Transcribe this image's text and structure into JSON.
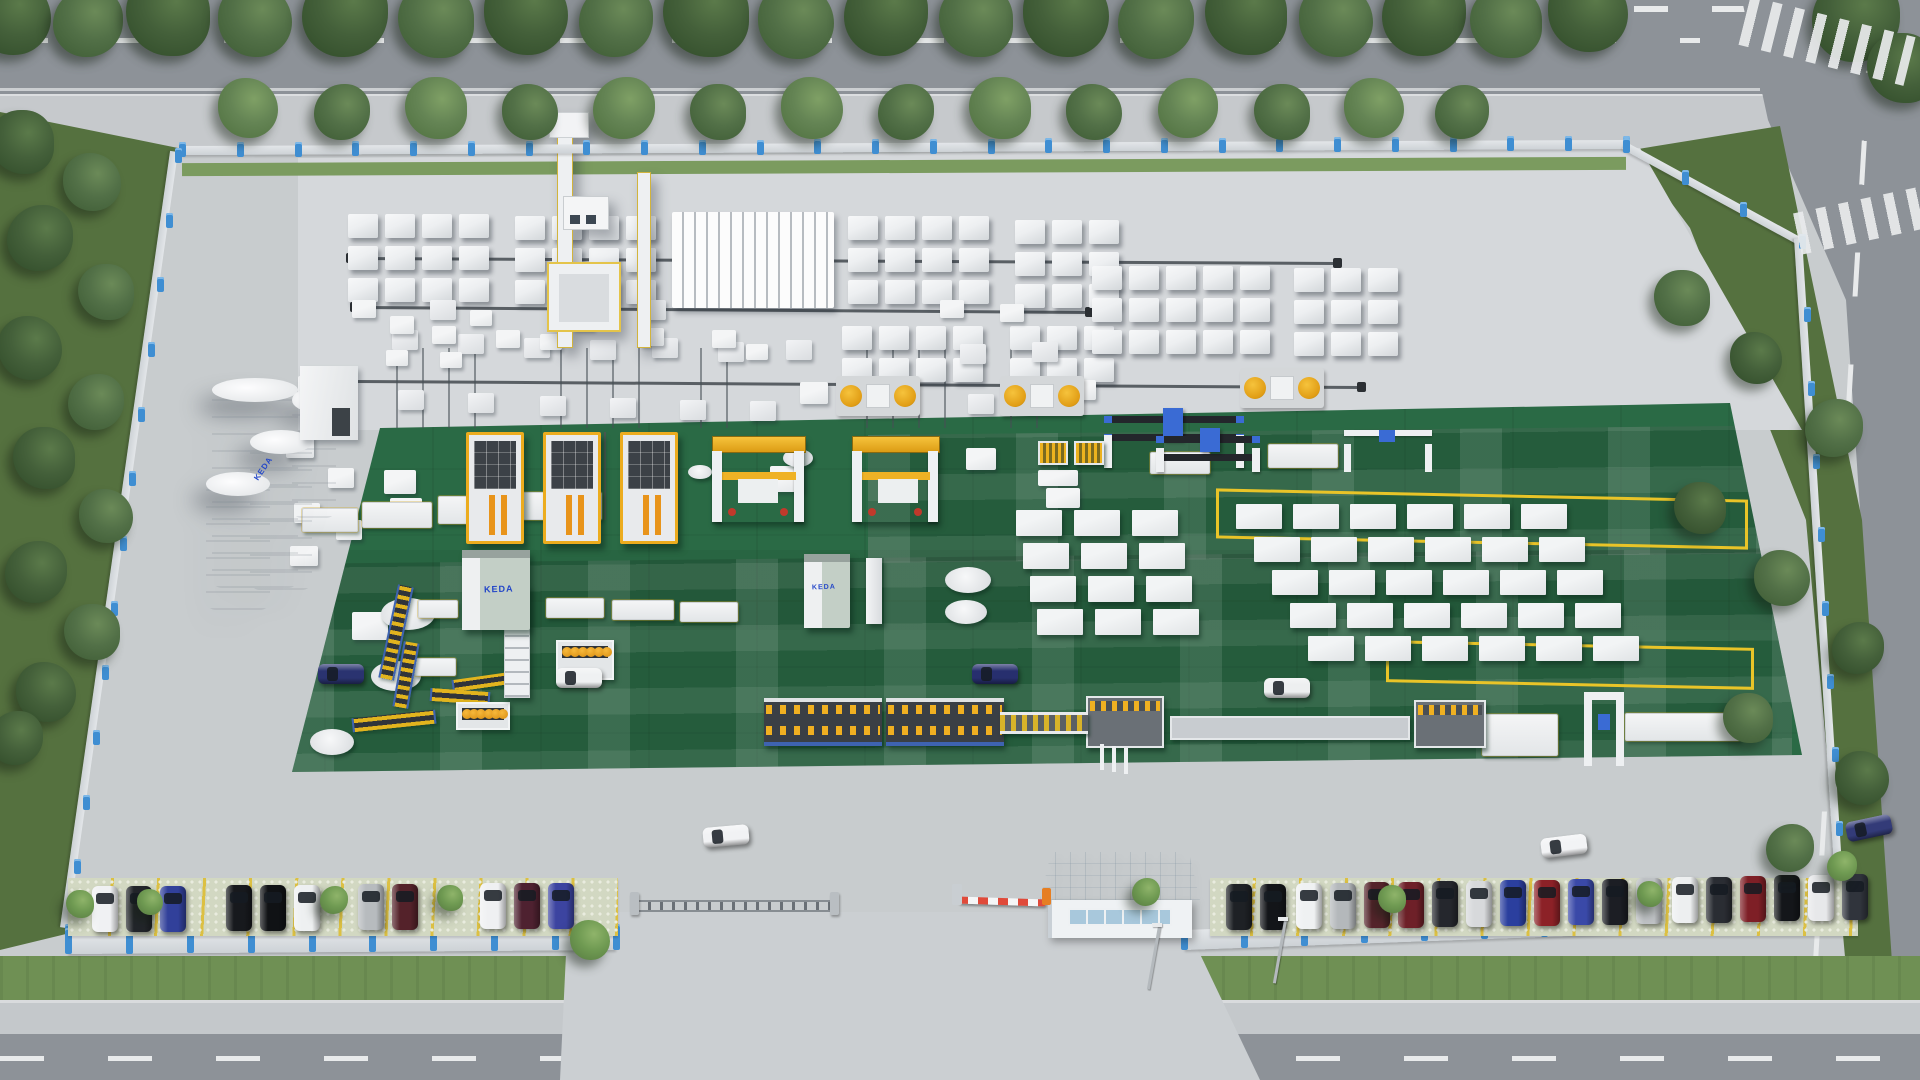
{
  "logo": {
    "text": "KEDA",
    "color": "#2447c8"
  },
  "palette": {
    "asphalt": "#8d9298",
    "sidewalk": "#c6c9cc",
    "apron": "#c8ccce",
    "apron_inner": "#d5d8db",
    "green_floor": "#2a6a45",
    "grass": "#6f9054",
    "grass_dark": "#55713f",
    "tree_dark": "#3f5c35",
    "tree_mid": "#587747",
    "tree_light": "#79965b",
    "bush": "#7da35c",
    "fence_wall": "#dadee1",
    "fence_post": "#3f8ed2",
    "block_white": "#eef0f2",
    "machine_yellow": "#f2b02a",
    "gantry_blue": "#3a6bd4",
    "keda_blue": "#2447c8",
    "silo_white": "#f3f4f5",
    "roof_blue": "#dfe7ed",
    "marking_yellow": "#e9c428",
    "parking_line": "#dcc043",
    "barrier_red": "#e04a3a",
    "road_line": "#e8eaeb",
    "rail": "#595f64"
  },
  "scene": {
    "trees": [
      [
        12,
        16,
        78,
        0
      ],
      [
        88,
        22,
        70,
        1
      ],
      [
        168,
        14,
        84,
        0
      ],
      [
        255,
        20,
        74,
        1
      ],
      [
        345,
        14,
        86,
        0
      ],
      [
        436,
        20,
        76,
        1
      ],
      [
        526,
        13,
        84,
        0
      ],
      [
        616,
        20,
        74,
        1
      ],
      [
        706,
        14,
        86,
        0
      ],
      [
        796,
        21,
        76,
        1
      ],
      [
        886,
        14,
        84,
        0
      ],
      [
        976,
        20,
        74,
        1
      ],
      [
        1066,
        14,
        86,
        0
      ],
      [
        1156,
        21,
        76,
        1
      ],
      [
        1246,
        14,
        82,
        0
      ],
      [
        1336,
        20,
        74,
        1
      ],
      [
        1424,
        14,
        84,
        0
      ],
      [
        1506,
        22,
        72,
        1
      ],
      [
        1588,
        12,
        80,
        0
      ],
      [
        1856,
        18,
        88,
        0
      ],
      [
        1902,
        68,
        70,
        0
      ],
      [
        248,
        108,
        60,
        2
      ],
      [
        342,
        112,
        56,
        1
      ],
      [
        436,
        108,
        62,
        2
      ],
      [
        530,
        112,
        56,
        1
      ],
      [
        624,
        108,
        62,
        2
      ],
      [
        718,
        112,
        56,
        1
      ],
      [
        812,
        108,
        62,
        2
      ],
      [
        906,
        112,
        56,
        1
      ],
      [
        1000,
        108,
        62,
        2
      ],
      [
        1094,
        112,
        56,
        1
      ],
      [
        1188,
        108,
        60,
        2
      ],
      [
        1282,
        112,
        56,
        1
      ],
      [
        1374,
        108,
        60,
        2
      ],
      [
        1462,
        112,
        54,
        1
      ],
      [
        22,
        142,
        64,
        0
      ],
      [
        92,
        182,
        58,
        1
      ],
      [
        40,
        238,
        66,
        0
      ],
      [
        106,
        292,
        56,
        1
      ],
      [
        30,
        348,
        64,
        0
      ],
      [
        96,
        402,
        56,
        1
      ],
      [
        44,
        458,
        62,
        0
      ],
      [
        106,
        516,
        54,
        1
      ],
      [
        36,
        572,
        62,
        0
      ],
      [
        92,
        632,
        56,
        1
      ],
      [
        46,
        692,
        60,
        0
      ],
      [
        16,
        738,
        54,
        0
      ],
      [
        1682,
        298,
        56,
        1
      ],
      [
        1756,
        358,
        52,
        0
      ],
      [
        1834,
        428,
        58,
        1
      ],
      [
        1700,
        508,
        52,
        0
      ],
      [
        1782,
        578,
        56,
        1
      ],
      [
        1858,
        648,
        52,
        0
      ],
      [
        1748,
        718,
        50,
        1
      ],
      [
        1862,
        778,
        54,
        0
      ],
      [
        1790,
        848,
        48,
        1
      ],
      [
        80,
        904,
        28,
        3
      ],
      [
        150,
        902,
        26,
        3
      ],
      [
        334,
        900,
        28,
        3
      ],
      [
        450,
        898,
        26,
        3
      ],
      [
        590,
        940,
        40,
        3
      ],
      [
        1146,
        892,
        28,
        3
      ],
      [
        1392,
        899,
        28,
        3
      ],
      [
        1650,
        894,
        26,
        3
      ],
      [
        1842,
        866,
        30,
        3
      ]
    ],
    "fence": [
      [
        182,
        146,
        1626,
        140,
        9,
        26
      ],
      [
        178,
        152,
        68,
        928,
        8,
        13
      ],
      [
        1626,
        142,
        1802,
        238,
        8,
        4
      ],
      [
        1802,
        238,
        1844,
        898,
        8,
        10
      ],
      [
        68,
        934,
        616,
        930,
        20,
        10
      ],
      [
        1184,
        930,
        1844,
        906,
        20,
        12
      ]
    ],
    "runways": [
      [
        352,
        257,
        1336,
        262
      ],
      [
        356,
        306,
        1088,
        311
      ],
      [
        352,
        380,
        1360,
        386
      ]
    ],
    "vrails": {
      "y": 348,
      "h": 80,
      "xs": [
        396,
        422,
        448,
        474,
        560,
        586,
        612,
        638,
        700,
        726,
        866,
        892,
        918,
        944,
        1010,
        1036
      ]
    },
    "grails": {
      "y": 432,
      "h": 88,
      "xs": [
        520,
        548,
        576,
        604,
        632,
        660
      ]
    },
    "block_clusters": [
      [
        348,
        214,
        4,
        3
      ],
      [
        515,
        216,
        4,
        3
      ],
      [
        848,
        216,
        4,
        3
      ],
      [
        842,
        326,
        4,
        2
      ],
      [
        1015,
        220,
        3,
        3
      ],
      [
        1010,
        326,
        3,
        2
      ],
      [
        1092,
        266,
        5,
        3
      ],
      [
        1294,
        268,
        3,
        3
      ]
    ],
    "block_train": [
      672,
      212,
      162,
      96
    ],
    "small_stacks": [
      [
        392,
        330
      ],
      [
        458,
        334
      ],
      [
        524,
        338
      ],
      [
        590,
        340
      ],
      [
        652,
        338
      ],
      [
        718,
        342
      ],
      [
        786,
        340
      ],
      [
        960,
        344
      ],
      [
        1032,
        342
      ],
      [
        398,
        390
      ],
      [
        468,
        393
      ],
      [
        540,
        396
      ],
      [
        610,
        398
      ],
      [
        680,
        400
      ],
      [
        750,
        401
      ],
      [
        968,
        394
      ],
      [
        1040,
        390
      ],
      [
        430,
        300
      ],
      [
        640,
        300
      ]
    ],
    "white_boxes": [
      [
        298,
        376,
        26,
        20
      ],
      [
        310,
        404,
        26,
        20
      ],
      [
        286,
        436,
        28,
        22
      ],
      [
        328,
        468,
        26,
        20
      ],
      [
        294,
        503,
        26,
        20
      ],
      [
        336,
        520,
        26,
        20
      ],
      [
        290,
        546,
        28,
        20
      ],
      [
        384,
        470,
        32,
        24
      ],
      [
        390,
        498,
        32,
        24
      ],
      [
        352,
        300,
        24,
        18
      ],
      [
        390,
        316,
        24,
        18
      ],
      [
        432,
        326,
        24,
        18
      ],
      [
        386,
        350,
        22,
        16
      ],
      [
        440,
        352,
        22,
        16
      ],
      [
        470,
        310,
        22,
        16
      ],
      [
        496,
        330,
        24,
        18
      ],
      [
        540,
        334,
        22,
        16
      ],
      [
        572,
        314,
        22,
        16
      ],
      [
        640,
        328,
        24,
        18
      ],
      [
        712,
        330,
        24,
        18
      ],
      [
        746,
        344,
        22,
        16
      ],
      [
        770,
        466,
        34,
        26
      ],
      [
        352,
        612,
        36,
        28
      ],
      [
        940,
        300,
        24,
        18
      ],
      [
        1000,
        304,
        24,
        18
      ],
      [
        800,
        382,
        28,
        22
      ],
      [
        1070,
        380,
        26,
        20
      ],
      [
        966,
        448,
        30,
        22
      ],
      [
        1038,
        470,
        40,
        16
      ],
      [
        1046,
        488,
        34,
        20
      ]
    ],
    "crate_grids": [
      {
        "x": 1016,
        "y": 510,
        "cols": 3,
        "rows": 4,
        "cw": 46,
        "ch": 26,
        "gx": 12,
        "gy": 7,
        "shift": 7
      },
      {
        "x": 1236,
        "y": 504,
        "cols": 6,
        "rows": 5,
        "cw": 46,
        "ch": 25,
        "gx": 11,
        "gy": 8,
        "shift": 18
      }
    ],
    "turntables": [
      [
        408,
        614,
        27,
        16
      ],
      [
        396,
        676,
        25,
        15
      ],
      [
        332,
        742,
        22,
        13
      ],
      [
        798,
        458,
        15,
        9
      ],
      [
        968,
        580,
        23,
        13
      ],
      [
        966,
        612,
        21,
        12
      ],
      [
        700,
        472,
        12,
        7
      ]
    ],
    "conveyor_tables": [
      [
        302,
        508,
        56,
        24
      ],
      [
        362,
        502,
        70,
        26
      ],
      [
        438,
        496,
        74,
        28
      ],
      [
        516,
        492,
        86,
        28
      ],
      [
        546,
        598,
        58,
        20
      ],
      [
        612,
        600,
        62,
        20
      ],
      [
        680,
        602,
        58,
        20
      ],
      [
        418,
        600,
        40,
        18
      ],
      [
        414,
        658,
        42,
        18
      ],
      [
        1150,
        452,
        60,
        22
      ],
      [
        1268,
        444,
        70,
        24
      ],
      [
        1482,
        714,
        76,
        42
      ],
      [
        1625,
        713,
        115,
        28
      ]
    ],
    "slat_conveyors": [
      [
        388,
        585,
        16,
        95,
        12
      ],
      [
        398,
        642,
        16,
        66,
        10
      ],
      [
        352,
        714,
        84,
        14,
        -6
      ],
      [
        452,
        676,
        60,
        12,
        -8
      ],
      [
        430,
        690,
        60,
        13,
        4
      ]
    ],
    "yellow_markings": [
      [
        1216,
        494,
        532,
        50
      ],
      [
        1386,
        644,
        368,
        42
      ]
    ],
    "shadow_bands": [
      [
        868,
        430,
        950,
        128
      ],
      [
        292,
        556,
        1500,
        216
      ]
    ],
    "machines": [
      {
        "k": "casting",
        "x": 466,
        "y": 432
      },
      {
        "k": "casting",
        "x": 543,
        "y": 432
      },
      {
        "k": "casting",
        "x": 620,
        "y": 432
      },
      {
        "k": "tilt",
        "x": 712,
        "y": 436,
        "w": 92,
        "h": 86
      },
      {
        "k": "tilt",
        "x": 852,
        "y": 436,
        "w": 86,
        "h": 86
      },
      {
        "k": "rotary",
        "x": 836,
        "y": 376
      },
      {
        "k": "rotary",
        "x": 1000,
        "y": 376
      },
      {
        "k": "rotary",
        "x": 1240,
        "y": 368
      },
      {
        "k": "bluegantry",
        "x": 1104,
        "y": 408,
        "w": 140,
        "h": 60
      },
      {
        "k": "bluegantry",
        "x": 1156,
        "y": 428,
        "w": 104,
        "h": 44
      },
      {
        "k": "whitegantry",
        "x": 1344,
        "y": 426,
        "w": 88,
        "h": 46
      },
      {
        "k": "rack",
        "x": 1038,
        "y": 441
      },
      {
        "k": "rack",
        "x": 1074,
        "y": 441
      },
      {
        "k": "spool",
        "x": 556,
        "y": 640,
        "w": 58,
        "h": 40
      },
      {
        "k": "spool",
        "x": 456,
        "y": 702,
        "w": 54,
        "h": 28
      },
      {
        "k": "bigline",
        "x": 764,
        "y": 698
      },
      {
        "k": "bigline",
        "x": 886,
        "y": 698
      },
      {
        "k": "graymach",
        "x": 1086,
        "y": 696,
        "w": 78,
        "h": 52
      },
      {
        "k": "graymach",
        "x": 1414,
        "y": 700,
        "w": 72,
        "h": 48
      },
      {
        "k": "connector",
        "x": 1000,
        "y": 712,
        "w": 88,
        "h": 22
      },
      {
        "k": "thinconv",
        "x": 1170,
        "y": 716,
        "w": 240,
        "h": 24
      },
      {
        "k": "gantryE",
        "x": 1584,
        "y": 692
      },
      {
        "k": "tower",
        "x": 504,
        "y": 586
      },
      {
        "k": "pillar",
        "x": 866,
        "y": 558
      },
      {
        "k": "post3",
        "x": 1100,
        "y": 744
      }
    ],
    "vehicles": {
      "parked": [
        [
          92,
          886,
          "#f0f1f3"
        ],
        [
          126,
          886,
          "#22252a"
        ],
        [
          160,
          886,
          "#31409a"
        ],
        [
          226,
          885,
          "#17191d"
        ],
        [
          260,
          885,
          "#101215"
        ],
        [
          294,
          885,
          "#eef0f1"
        ],
        [
          358,
          884,
          "#b7bbbe"
        ],
        [
          392,
          884,
          "#54222a"
        ],
        [
          480,
          883,
          "#eff0f2"
        ],
        [
          514,
          883,
          "#4e2130"
        ],
        [
          548,
          883,
          "#3c44a0"
        ],
        [
          1226,
          884,
          "#1e2125"
        ],
        [
          1260,
          884,
          "#131519"
        ],
        [
          1296,
          883,
          "#eff1f2"
        ],
        [
          1330,
          883,
          "#b4b8bb"
        ],
        [
          1364,
          882,
          "#55242b"
        ],
        [
          1398,
          882,
          "#6e2028"
        ],
        [
          1432,
          881,
          "#25272d"
        ],
        [
          1466,
          881,
          "#d7d9db"
        ],
        [
          1500,
          880,
          "#2b3f9e"
        ],
        [
          1534,
          880,
          "#8c2127"
        ],
        [
          1568,
          879,
          "#3a49a8"
        ],
        [
          1602,
          879,
          "#1c1e24"
        ],
        [
          1636,
          878,
          "#bfc2c5"
        ],
        [
          1672,
          877,
          "#edeff0"
        ],
        [
          1706,
          877,
          "#2a2d33"
        ],
        [
          1740,
          876,
          "#7e1f26"
        ],
        [
          1774,
          875,
          "#14161a"
        ],
        [
          1808,
          875,
          "#e7e8ea"
        ],
        [
          1842,
          874,
          "#30343c"
        ]
      ],
      "moving": [
        [
          318,
          664,
          "#2a3370",
          0
        ],
        [
          556,
          668,
          "#eff1f2",
          0
        ],
        [
          972,
          664,
          "#272f6e",
          0
        ],
        [
          1264,
          678,
          "#edeff0",
          0
        ],
        [
          703,
          826,
          "#f1f2f4",
          -5
        ],
        [
          1541,
          836,
          "#f2f3f5",
          -7
        ],
        [
          1846,
          818,
          "#333b78",
          -12
        ]
      ]
    },
    "parking_strips": [
      [
        68,
        878,
        550
      ],
      [
        1210,
        878,
        648
      ]
    ],
    "street_poles": [
      [
        1158,
        926,
        64,
        10
      ],
      [
        1284,
        920,
        64,
        10
      ]
    ],
    "zebras": [
      [
        1742,
        16,
        170,
        50,
        14
      ],
      [
        1796,
        200,
        126,
        42,
        -12
      ]
    ]
  }
}
